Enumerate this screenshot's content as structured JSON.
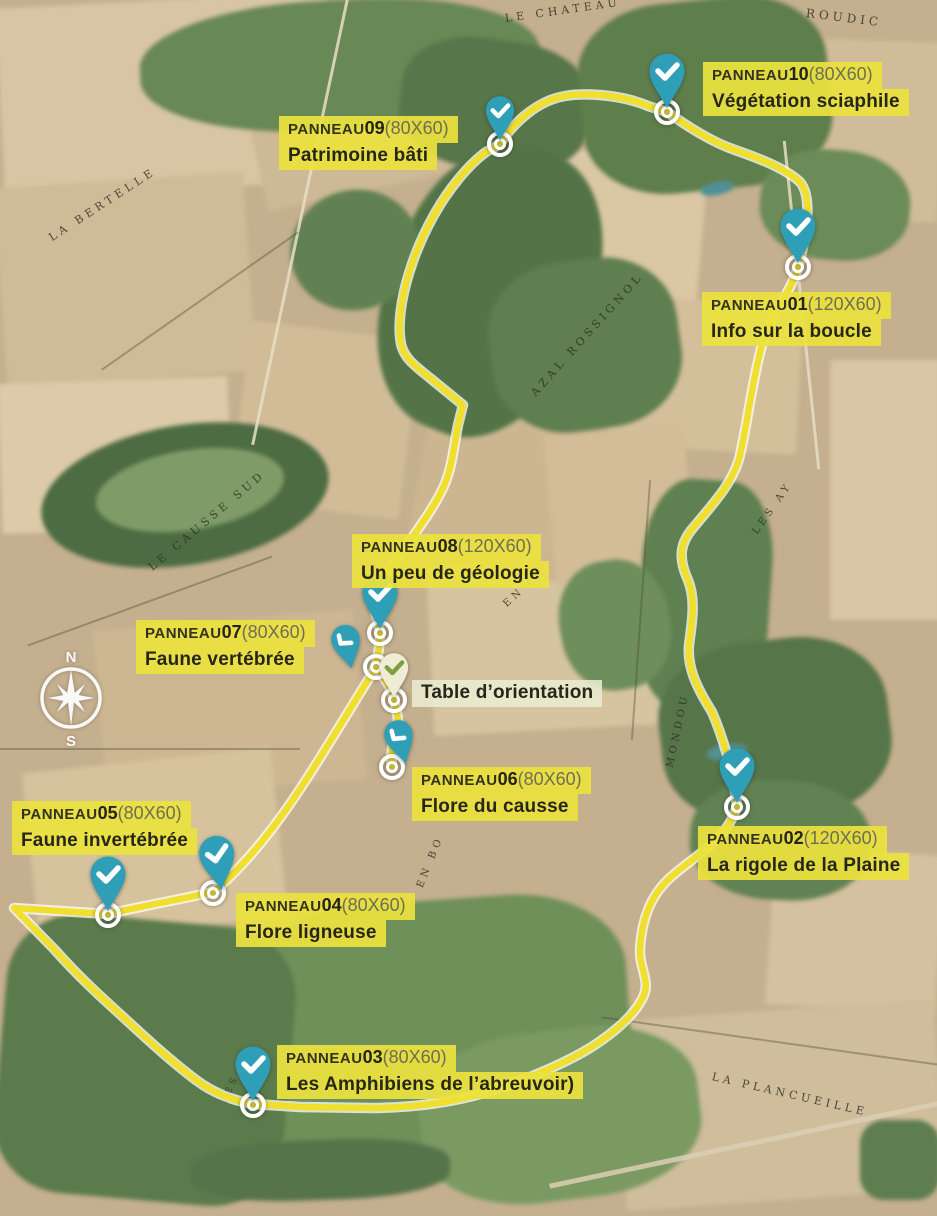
{
  "colors": {
    "label_yellow": "#ebe23e",
    "route_yellow": "#f1df2e",
    "pin_teal": "#2f9fb8",
    "table_pin_cream": "#f0edd6",
    "table_check_green": "#7fa03e"
  },
  "panels": [
    {
      "prefix": "PANNEAU",
      "number": "01",
      "size": "(120X60)",
      "title": "Info sur la boucle"
    },
    {
      "prefix": "PANNEAU",
      "number": "02",
      "size": "(120X60)",
      "title": "La rigole de la Plaine"
    },
    {
      "prefix": "PANNEAU",
      "number": "03",
      "size": "(80X60)",
      "title": "Les Amphibiens de l’abreuvoir)"
    },
    {
      "prefix": "PANNEAU",
      "number": "04",
      "size": "(80X60)",
      "title": "Flore ligneuse"
    },
    {
      "prefix": "PANNEAU",
      "number": "05",
      "size": "(80X60)",
      "title": "Faune invertébrée"
    },
    {
      "prefix": "PANNEAU",
      "number": "06",
      "size": "(80X60)",
      "title": "Flore du causse"
    },
    {
      "prefix": "PANNEAU",
      "number": "07",
      "size": "(80X60)",
      "title": "Faune vertébrée"
    },
    {
      "prefix": "PANNEAU",
      "number": "08",
      "size": "(120X60)",
      "title": "Un peu de géologie"
    },
    {
      "prefix": "PANNEAU",
      "number": "09",
      "size": "(80X60)",
      "title": "Patrimoine bâti"
    },
    {
      "prefix": "PANNEAU",
      "number": "10",
      "size": "(80X60)",
      "title": "Végétation sciaphile"
    }
  ],
  "table_orientation": {
    "label": "Table d’orientation"
  },
  "map": {
    "compass": {
      "north": "N",
      "south": "S"
    },
    "place_labels": [
      {
        "text": "LE CHATEAU"
      },
      {
        "text": "ROUDIC"
      },
      {
        "text": "LA BERTELLE"
      },
      {
        "text": "AZAL ROSSIGNOL"
      },
      {
        "text": "LE CAUSSE SUD"
      },
      {
        "text": "LES AY"
      },
      {
        "text": "EN CA"
      },
      {
        "text": "MONDOU"
      },
      {
        "text": "EN BO"
      },
      {
        "text": "LA PLANCUEILLE"
      },
      {
        "text": "LES"
      }
    ]
  }
}
